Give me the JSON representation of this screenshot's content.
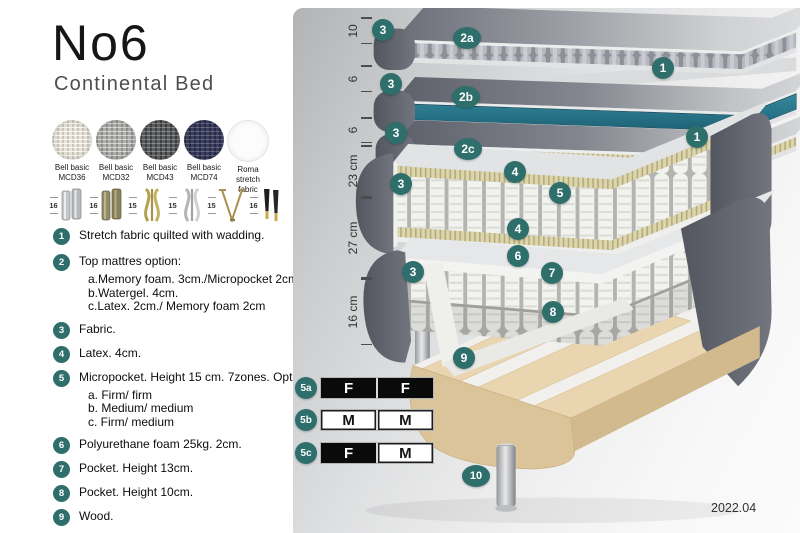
{
  "header": {
    "title": "No6",
    "subtitle": "Continental Bed"
  },
  "fabrics": [
    {
      "name": "Bell basic",
      "code": "MCD36"
    },
    {
      "name": "Bell basic",
      "code": "MCD32"
    },
    {
      "name": "Bell basic",
      "code": "MCD43"
    },
    {
      "name": "Bell basic",
      "code": "MCD74"
    },
    {
      "name": "Roma",
      "code": "stretch fabric"
    }
  ],
  "legs": [
    {
      "size": "16",
      "type": "cylinder-silver"
    },
    {
      "size": "16",
      "type": "cylinder-brass"
    },
    {
      "size": "15",
      "type": "twisted-gold"
    },
    {
      "size": "15",
      "type": "twisted-silver"
    },
    {
      "size": "15",
      "type": "hairpin-gold"
    },
    {
      "size": "16",
      "type": "tapered-black-gold"
    }
  ],
  "legend": {
    "items": [
      {
        "num": "1",
        "text": "Stretch fabric quilted with wadding."
      },
      {
        "num": "2",
        "text": "Top mattres option:",
        "subs": [
          "a.Memory foam. 3cm./Micropocket 2cm",
          "b.Watergel. 4cm.",
          "c.Latex. 2cm./ Memory foam 2cm"
        ]
      },
      {
        "num": "3",
        "text": "Fabric."
      },
      {
        "num": "4",
        "text": "Latex. 4cm."
      },
      {
        "num": "5",
        "text": "Micropocket. Height 15 cm. 7zones. Option:",
        "subs": [
          "a. Firm/ firm",
          "b. Medium/ medium",
          "c. Firm/ medium"
        ]
      },
      {
        "num": "6",
        "text": "Polyurethane foam 25kg. 2cm."
      },
      {
        "num": "7",
        "text": "Pocket. Height 13cm."
      },
      {
        "num": "8",
        "text": "Pocket. Height 10cm."
      },
      {
        "num": "9",
        "text": "Wood."
      },
      {
        "num": "10",
        "text": "Metal leg. Height 16cm."
      }
    ]
  },
  "diagram": {
    "ruler": [
      "10",
      "6",
      "6",
      "23 cm",
      "27 cm",
      "16 cm"
    ],
    "badges": [
      "3",
      "2a",
      "1",
      "3",
      "2b",
      "3",
      "2c",
      "1",
      "4",
      "5",
      "3",
      "4",
      "6",
      "7",
      "3",
      "8",
      "9",
      "10"
    ],
    "firmness": {
      "rows": [
        {
          "label": "5a",
          "cells": [
            {
              "v": "F"
            },
            {
              "v": "F"
            }
          ]
        },
        {
          "label": "5b",
          "cells": [
            {
              "v": "M"
            },
            {
              "v": "M"
            }
          ]
        },
        {
          "label": "5c",
          "cells": [
            {
              "v": "F"
            },
            {
              "v": "M"
            }
          ]
        }
      ]
    },
    "footer": "2022.04"
  },
  "colors": {
    "badge_teal": "#2e6f6c",
    "watergel": "#2b7a8e",
    "fabric_dark": "#62656e",
    "wood": "#ddc59b"
  }
}
